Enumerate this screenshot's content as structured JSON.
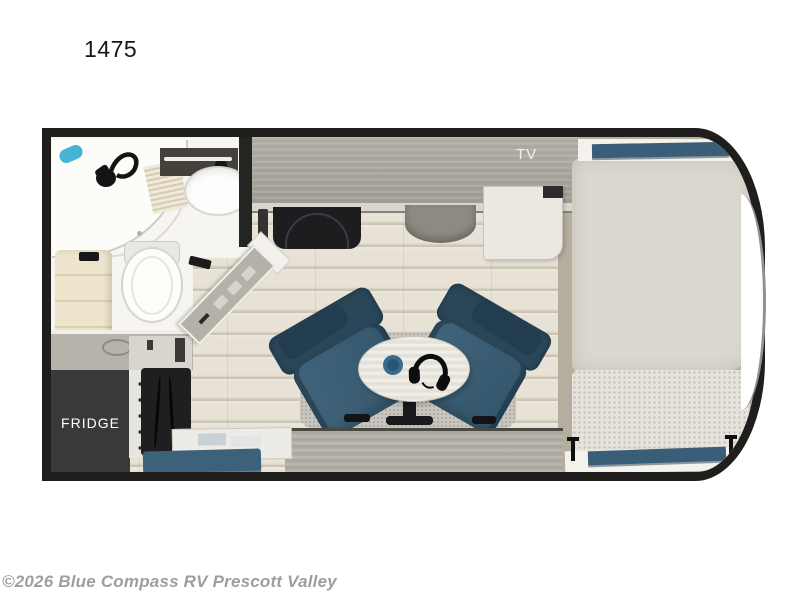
{
  "header": {
    "model_number": "1475"
  },
  "floorplan": {
    "labels": {
      "tv": "TV",
      "fridge": "FRIDGE"
    },
    "accent_colors": {
      "wall": "#1f1e1c",
      "upholstery_blue": "#3a5e77",
      "floor_wood": "#e7e2d5",
      "cabinet_gray": "#aca79f",
      "fridge_panel": "#39393b",
      "mattress": "#dbd8cf",
      "bench_cream": "#ede5cb",
      "shower_accent_blue": "#45b4d6"
    },
    "furniture": [
      "shower",
      "bathroom-sink",
      "toilet",
      "wardrobe-bench",
      "refrigerator",
      "oven",
      "kitchen-counter",
      "cooktop",
      "kitchen-sink",
      "entry-door",
      "tv-cabinet",
      "recliner-chair-left",
      "recliner-chair-right",
      "side-table",
      "headphones",
      "mug",
      "rug",
      "bed",
      "storage-bench",
      "front-window"
    ]
  },
  "footer": {
    "copyright": "©2026 Blue Compass RV Prescott Valley"
  }
}
